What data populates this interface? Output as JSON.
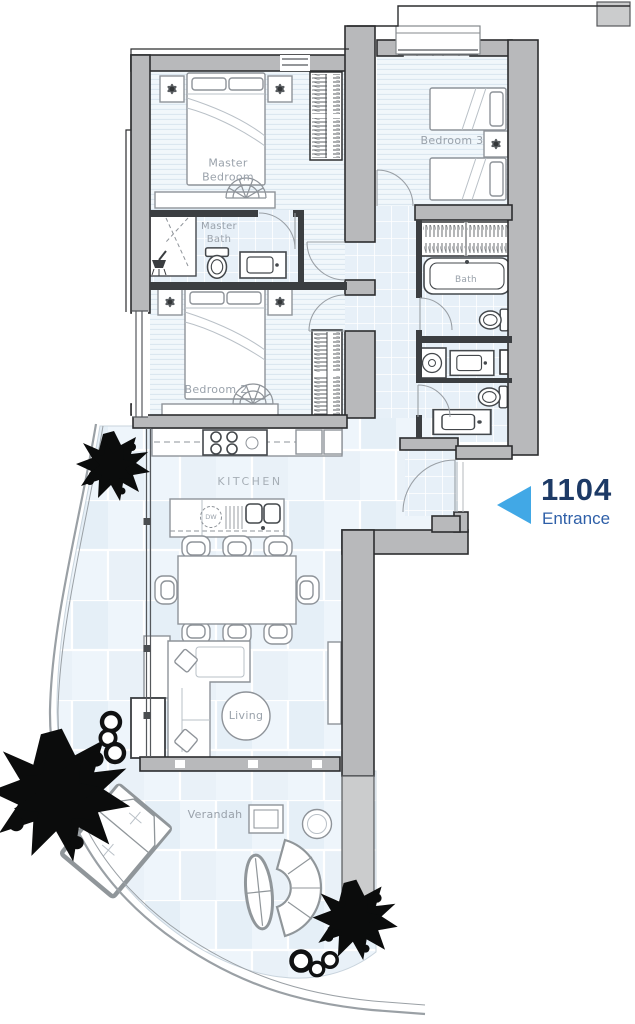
{
  "unit": {
    "number": "1104",
    "entrance_label": "Entrance"
  },
  "rooms": {
    "master_bedroom": "Master Bedroom",
    "master_bath": "Master Bath",
    "bedroom_2": "Bedroom 2",
    "bedroom_3": "Bedroom 3",
    "bath": "Bath",
    "kitchen": "KITCHEN",
    "living": "Living",
    "verandah": "Verandah"
  },
  "appliances": {
    "dishwasher": "DW"
  },
  "icons": [
    "entrance-arrow-icon",
    "tree-icon",
    "planter-pot-icon"
  ],
  "colors": {
    "arrow": "#41a8e6",
    "unit_number": "#1d3a66",
    "entrance_text": "#2e5fa8",
    "label_text": "#9aa2ab",
    "wall_fill": "#b8b9bb",
    "wall_light": "#cbcccd",
    "floor_tint": "#ecf3fa",
    "tree": "#0b0c0c"
  }
}
